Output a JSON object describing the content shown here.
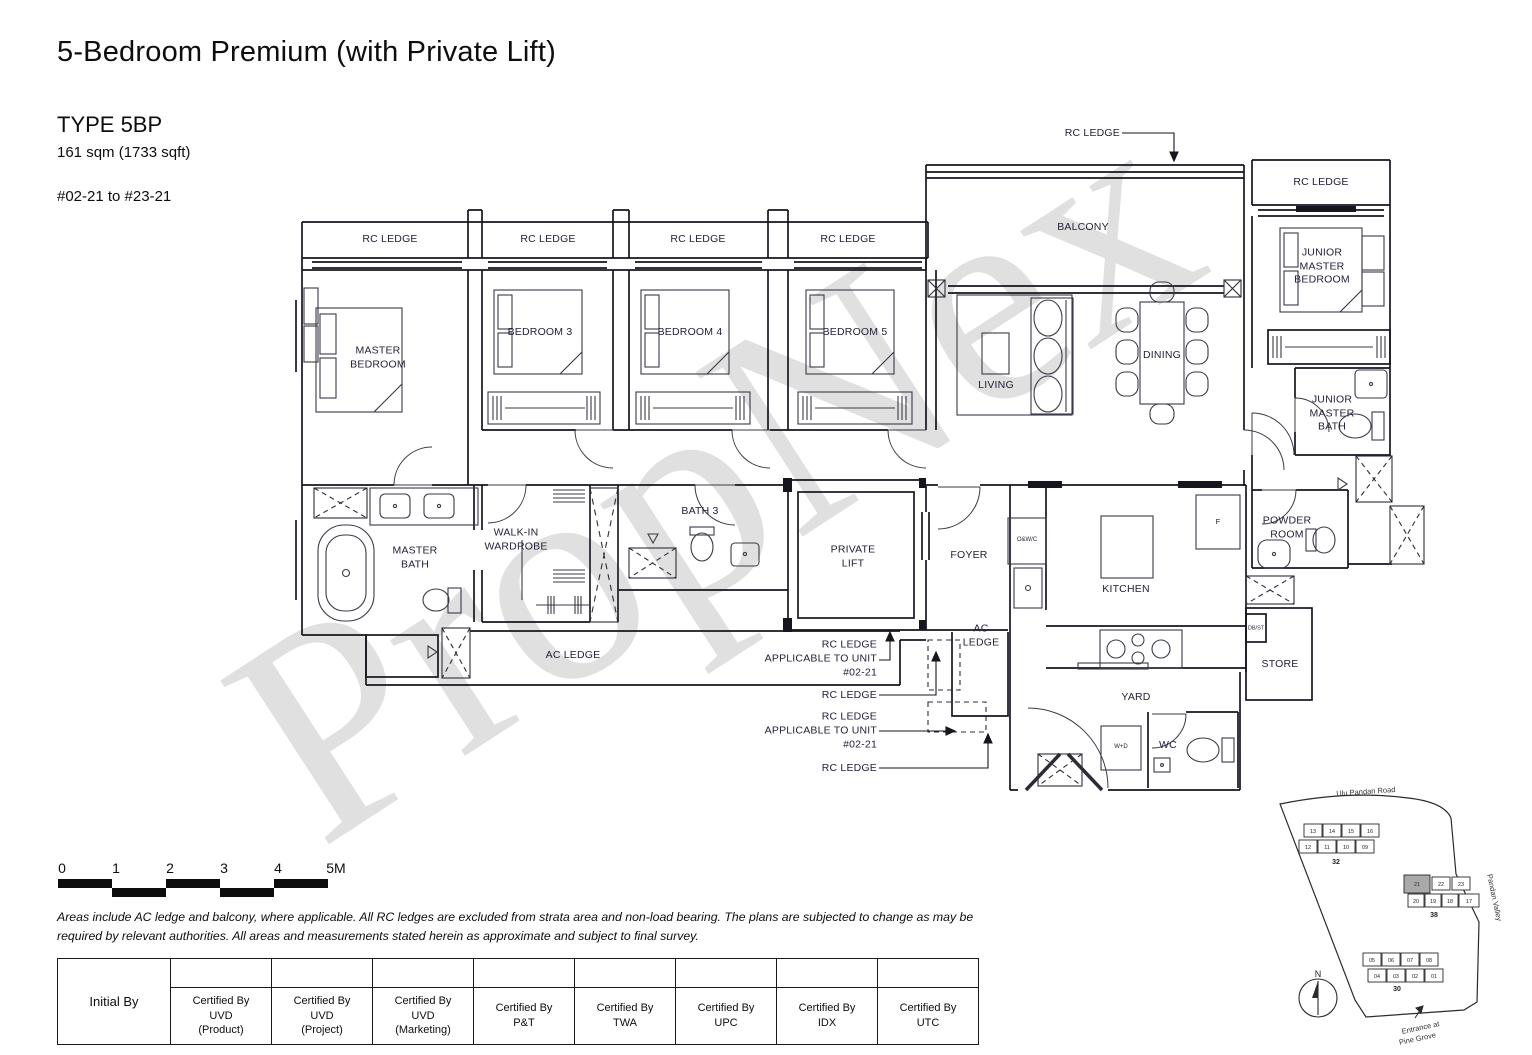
{
  "header": {
    "title": "5-Bedroom Premium (with Private Lift)",
    "type": "TYPE 5BP",
    "area": "161 sqm (1733 sqft)",
    "units": "#02-21 to #23-21"
  },
  "watermark": "PropNex",
  "plan": {
    "labels": {
      "rc_ledge": "RC LEDGE",
      "master_bedroom": "MASTER\nBEDROOM",
      "bedroom_3": "BEDROOM 3",
      "bedroom_4": "BEDROOM 4",
      "bedroom_5": "BEDROOM 5",
      "balcony": "BALCONY",
      "living": "LIVING",
      "dining": "DINING",
      "junior_master_bedroom": "JUNIOR\nMASTER\nBEDROOM",
      "junior_master_bath": "JUNIOR\nMASTER\nBATH",
      "master_bath": "MASTER\nBATH",
      "walk_in_wardrobe": "WALK-IN\nWARDROBE",
      "bath_3": "BATH 3",
      "private_lift": "PRIVATE\nLIFT",
      "foyer": "FOYER",
      "kitchen": "KITCHEN",
      "powder_room": "POWDER\nROOM",
      "store": "STORE",
      "yard": "YARD",
      "wc": "WC",
      "ac_ledge": "AC LEDGE",
      "ac_ledge_stacked": "AC\nLEDGE"
    },
    "fixtures": {
      "owc": "O&W/C",
      "fridge": "F",
      "dbst": "DB/ST",
      "washer_dryer": "W+D"
    },
    "callouts": {
      "rc_ledge": "RC LEDGE",
      "rc_ledge_unit": "RC LEDGE\nAPPLICABLE TO UNIT\n#02-21"
    }
  },
  "scale_bar": {
    "labels": [
      "0",
      "1",
      "2",
      "3",
      "4",
      "5M"
    ]
  },
  "disclaimer": "Areas include AC ledge and balcony, where applicable. All RC ledges are excluded from strata area and non-load bearing. The plans are subjected to change as may be required by relevant authorities. All areas and measurements stated herein as approximate and subject to final survey.",
  "cert_table": {
    "initial_by": "Initial By",
    "columns": [
      {
        "text": "Certified By\nUVD\n(Product)"
      },
      {
        "text": "Certified By\nUVD\n(Project)"
      },
      {
        "text": "Certified By\nUVD\n(Marketing)"
      },
      {
        "text": "Certified By\nP&T"
      },
      {
        "text": "Certified By\nTWA"
      },
      {
        "text": "Certified By\nUPC"
      },
      {
        "text": "Certified By\nIDX"
      },
      {
        "text": "Certified By\nUTC"
      }
    ]
  },
  "sitemap": {
    "road_top": "Ulu Pandan Road",
    "road_right": "Pandan Valley",
    "entrance_line1": "Entrance at",
    "entrance_line2": "Pine Grove",
    "north": "N",
    "highlight_color": "#a9a9a9",
    "clusters": [
      {
        "label": "32",
        "units_top": [
          "13",
          "14",
          "15",
          "16"
        ],
        "units_bottom": [
          "12",
          "11",
          "10",
          "09"
        ]
      },
      {
        "label": "38",
        "units_top": [
          "21",
          "22",
          "23"
        ],
        "units_bottom": [
          "20",
          "19",
          "18",
          "17"
        ]
      },
      {
        "label": "30",
        "units_top": [
          "05",
          "06",
          "07",
          "08"
        ],
        "units_bottom": [
          "04",
          "03",
          "02",
          "01"
        ]
      }
    ]
  }
}
